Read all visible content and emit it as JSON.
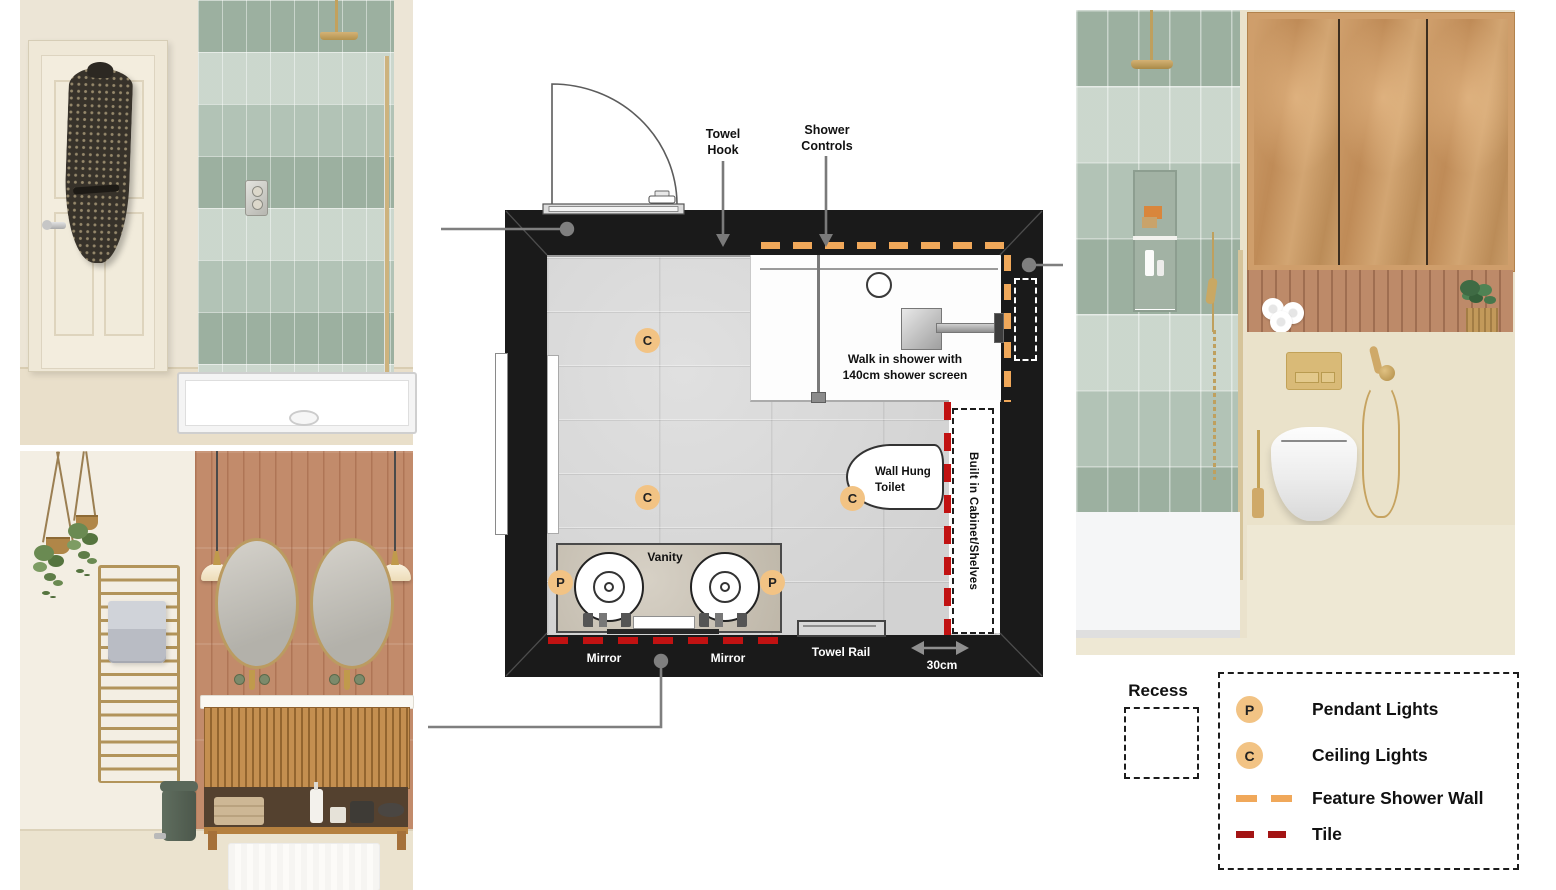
{
  "colors": {
    "wall-black": "#1a1a1a",
    "marker-fill": "#f2c384",
    "feature-orange": "#f0a85a",
    "tile-red": "#c11212",
    "legend-tile-red": "#a31414",
    "leader-gray": "#7f7f7f"
  },
  "floor_plan": {
    "annotations": {
      "towel_hook": "Towel Hook",
      "shower_controls": "Shower Controls",
      "walk_in_shower": "Walk in shower with 140cm shower screen",
      "wall_hung_toilet": "Wall Hung Toilet",
      "vanity": "Vanity",
      "mirror_left": "Mirror",
      "mirror_right": "Mirror",
      "towel_rail": "Towel Rail",
      "built_in_cabinet": "Built in Cabinet/Shelves",
      "cabinet_depth": "30cm"
    },
    "markers": {
      "pendant_symbol": "P",
      "ceiling_symbol": "C"
    }
  },
  "legend": {
    "recess_label": "Recess",
    "items": [
      {
        "symbol": "P",
        "label": "Pendant Lights"
      },
      {
        "symbol": "C",
        "label": "Ceiling Lights"
      },
      {
        "symbol": "dash-orange",
        "label": "Feature Shower Wall"
      },
      {
        "symbol": "dash-red",
        "label": "Tile"
      }
    ]
  }
}
